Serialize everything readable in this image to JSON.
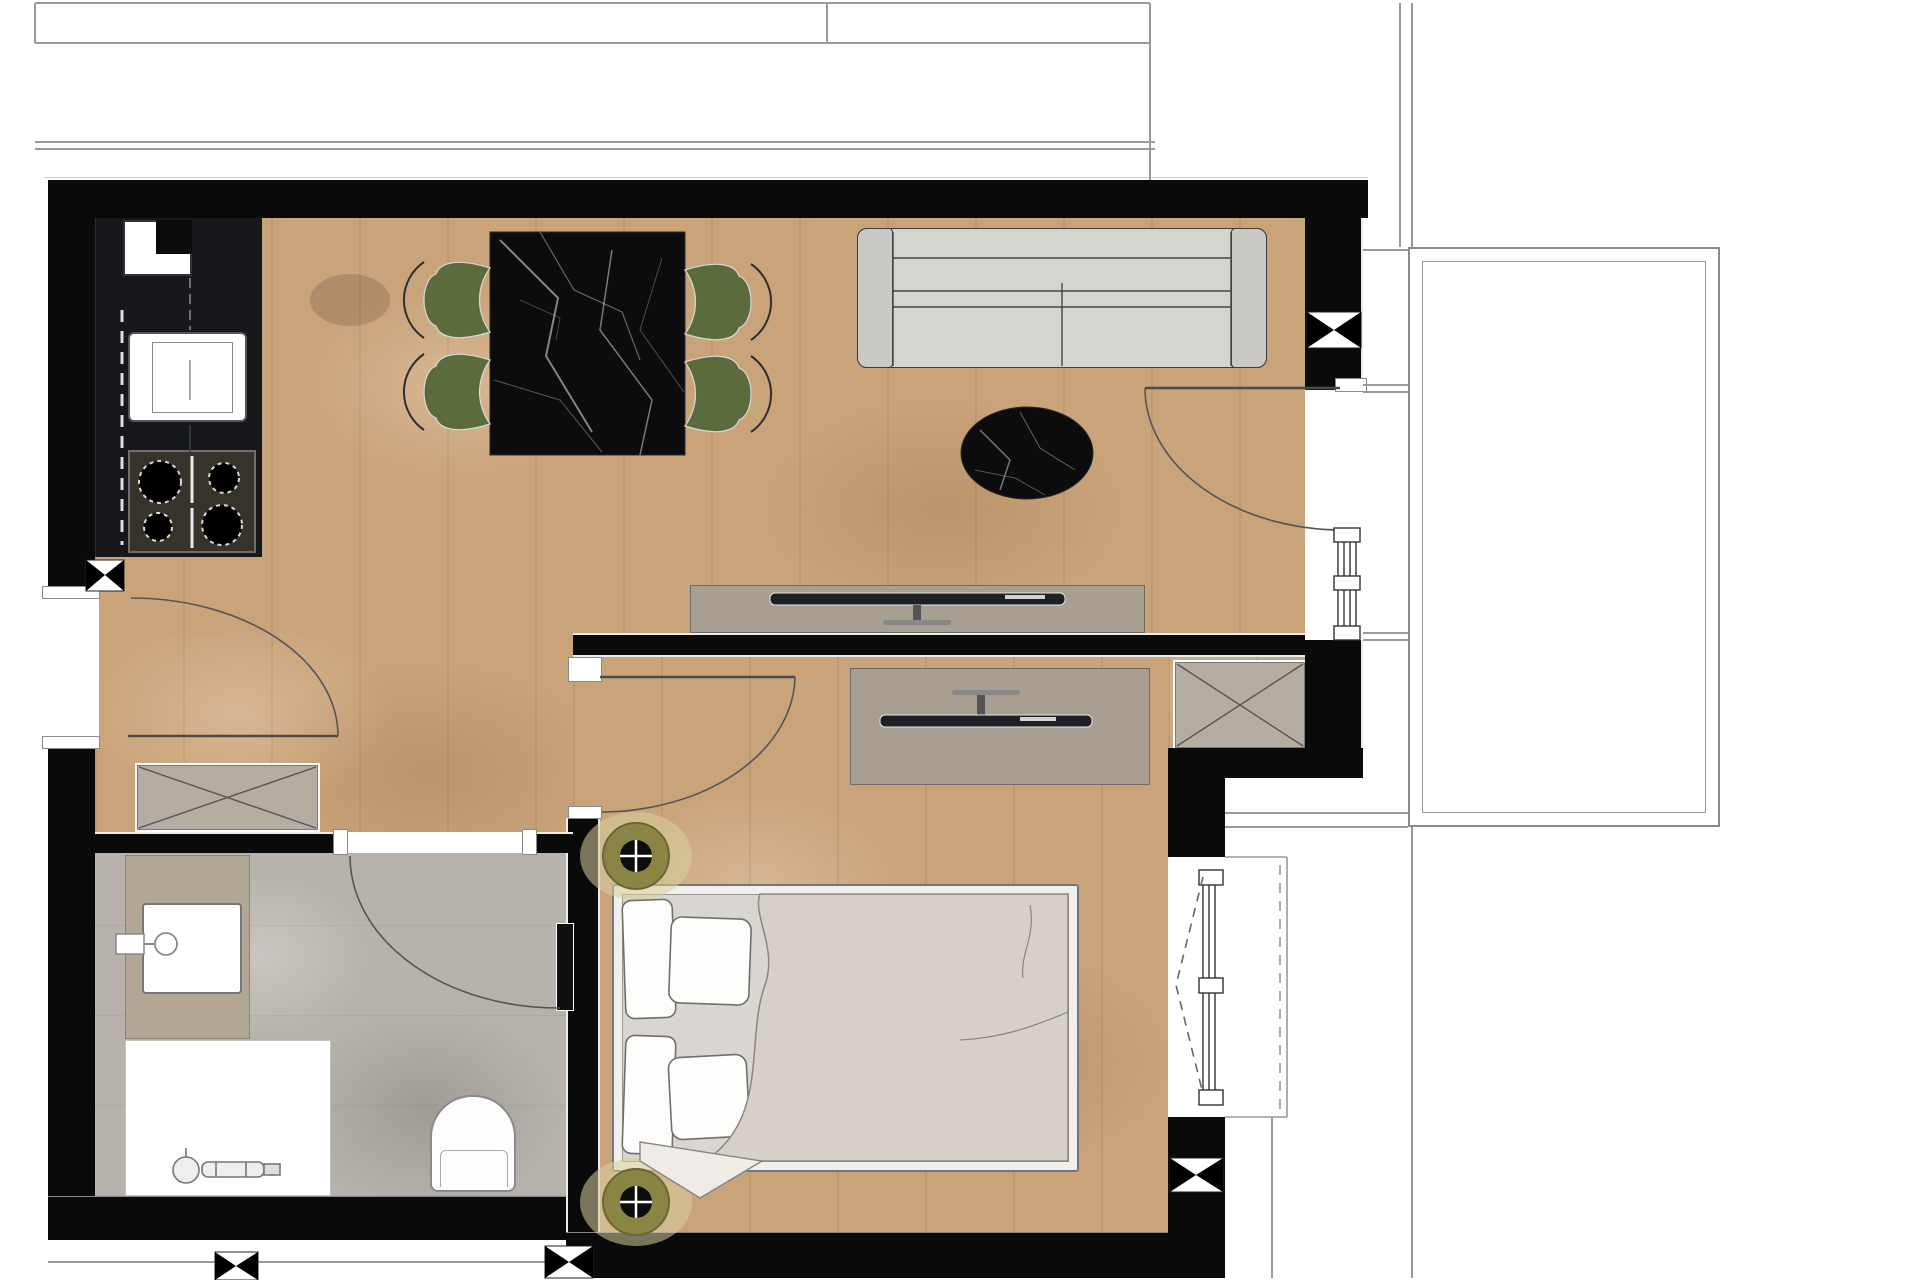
{
  "document": {
    "type": "architectural-floor-plan",
    "title": "One-bedroom apartment floor plan (top view, rendered)",
    "visible_text": [],
    "orientation": "balcony on right side"
  },
  "palette": {
    "wall": "#0a0a0b",
    "wood": "#c9a37a",
    "tile": "#b7b3ac",
    "counter": "#16181c",
    "cooktop": "#37322a",
    "marble": "#0c0c0e",
    "chair": "#5c6b3d",
    "sofa": "#d5d4d1",
    "sofa-arm": "#cac9c5",
    "console": "#a89f92",
    "wardrobe": "#b5ada1",
    "vanity": "#b2a794",
    "bedframe": "#f1efec",
    "mattress": "#d9d5d0",
    "duvet": "#d6d0c9",
    "pillow": "#fdfdfc",
    "glow": "#d8cf9f",
    "ring": "#8a8445",
    "line": "#555555",
    "thin": "#9a9a9a"
  },
  "rooms": [
    {
      "name": "living-dining-kitchen",
      "floor": "oak parquet"
    },
    {
      "name": "hallway",
      "floor": "oak parquet"
    },
    {
      "name": "bedroom",
      "floor": "oak parquet"
    },
    {
      "name": "bathroom",
      "floor": "grey stone tile"
    },
    {
      "name": "balcony",
      "floor": "outline only"
    }
  ],
  "furniture": [
    {
      "name": "kitchen-counter",
      "room": "living-dining-kitchen"
    },
    {
      "name": "kitchen-sink",
      "room": "living-dining-kitchen"
    },
    {
      "name": "cooktop-4-burners",
      "room": "living-dining-kitchen"
    },
    {
      "name": "dining-table-black-marble",
      "room": "living-dining-kitchen",
      "chairs": 4,
      "chair_color": "olive-green"
    },
    {
      "name": "sofa-two-seater",
      "room": "living-dining-kitchen"
    },
    {
      "name": "coffee-table-oval-black-marble",
      "room": "living-dining-kitchen"
    },
    {
      "name": "tv-sideboard-living",
      "room": "living-dining-kitchen",
      "tv": true
    },
    {
      "name": "tv-sideboard-bedroom",
      "room": "bedroom",
      "tv": true
    },
    {
      "name": "wardrobe-hallway-x-symbol",
      "room": "hallway"
    },
    {
      "name": "wardrobe-bedroom-x-symbol",
      "room": "bedroom"
    },
    {
      "name": "double-bed",
      "room": "bedroom",
      "pillows": 4,
      "duvet": true
    },
    {
      "name": "vanity-with-basin",
      "room": "bathroom"
    },
    {
      "name": "shower-tray",
      "room": "bathroom"
    },
    {
      "name": "toilet",
      "room": "bathroom"
    }
  ],
  "openings": [
    {
      "name": "entry-door",
      "wall": "west",
      "swing": "into hallway"
    },
    {
      "name": "bathroom-door",
      "wall": "hallway-bathroom",
      "swing": "into bathroom"
    },
    {
      "name": "bedroom-door",
      "wall": "hallway-bedroom",
      "swing": "into bedroom"
    },
    {
      "name": "balcony-door",
      "wall": "east",
      "swing": "into living room"
    },
    {
      "name": "living-window",
      "wall": "east"
    },
    {
      "name": "bedroom-window",
      "wall": "east",
      "symbol": "dashed casement arrow"
    }
  ],
  "symbols": [
    {
      "name": "section-marker-bowtie",
      "count": 5
    },
    {
      "name": "ceiling-spotlight",
      "count": 2,
      "color": "olive"
    },
    {
      "name": "door-swing-arc",
      "count": 4
    }
  ]
}
